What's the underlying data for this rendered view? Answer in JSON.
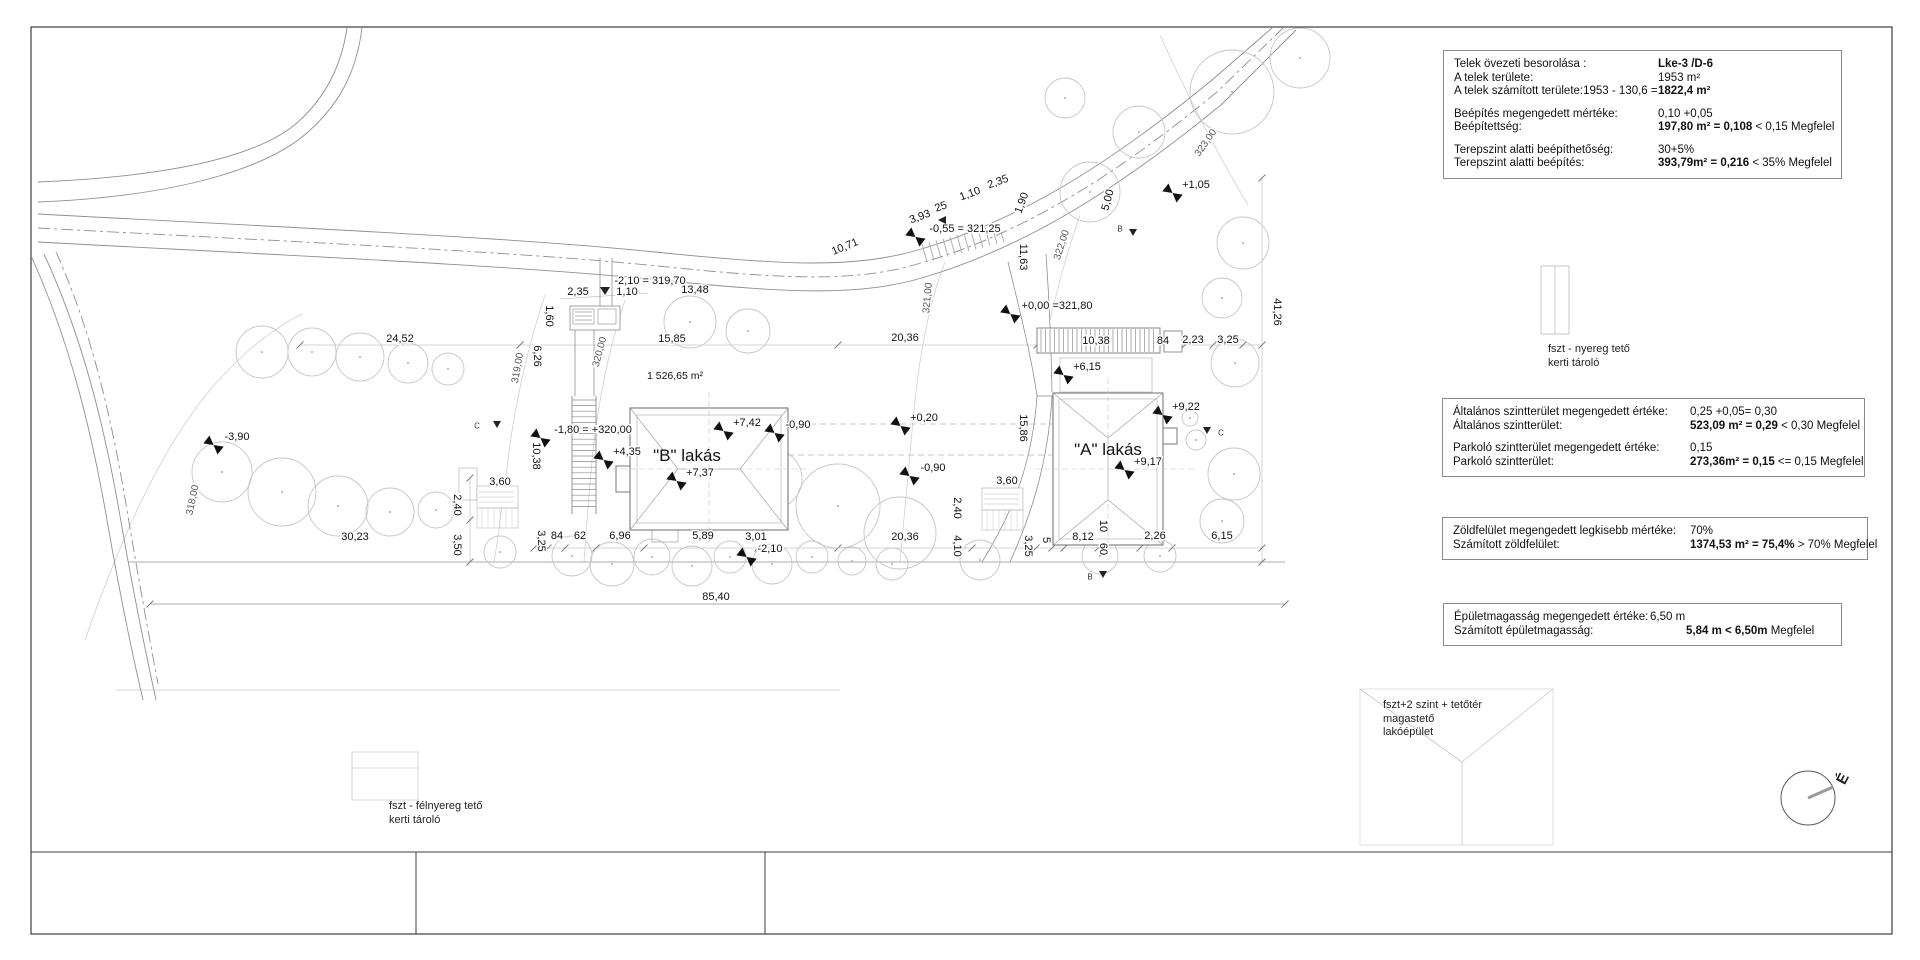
{
  "colors": {
    "frame": "#3c3c3c",
    "line": "#8f8f8f",
    "light": "#c8c8c8",
    "tree": "#c6c6c6",
    "text": "#111111"
  },
  "north": {
    "label": "É",
    "x": 1843,
    "y": 779
  },
  "info_boxes": [
    {
      "id": "zoning",
      "x": 1443,
      "y": 50,
      "w": 377,
      "label_w": 204,
      "rows": [
        {
          "l": "Telek övezeti besorolása :",
          "v": [
            {
              "t": "Lke-3 /D-6",
              "b": 1
            }
          ]
        },
        {
          "l": "A telek területe:",
          "v": [
            {
              "t": "1953 m²",
              "b": 0
            }
          ]
        },
        {
          "l": "A telek számított területe:1953 - 130,6 =",
          "v": [
            {
              "t": "1822,4 m²",
              "b": 1
            }
          ]
        },
        {
          "gap": 1
        },
        {
          "l": "Beépítés megengedett mértéke:",
          "v": [
            {
              "t": "0,10 +0,05",
              "b": 0
            }
          ]
        },
        {
          "l": "Beépítettség:",
          "v": [
            {
              "t": "197,80 m² = 0,108",
              "b": 1
            },
            {
              "t": " < 0,15 Megfelel",
              "b": 0
            }
          ]
        },
        {
          "gap": 1
        },
        {
          "l": "Terepszint alatti beépíthetőség:",
          "v": [
            {
              "t": "30+5%",
              "b": 0
            }
          ]
        },
        {
          "l": "Terepszint alatti beépítés:",
          "v": [
            {
              "t": "393,79m² = 0,216",
              "b": 1
            },
            {
              "t": " < 35%  Megfelel",
              "b": 0
            }
          ]
        }
      ]
    },
    {
      "id": "floor",
      "x": 1442,
      "y": 398,
      "w": 401,
      "label_w": 237,
      "rows": [
        {
          "l": "Általános szintterület megengedett értéke:",
          "v": [
            {
              "t": "0,25 +0,05= 0,30",
              "b": 0
            }
          ]
        },
        {
          "l": "Általános szintterület:",
          "v": [
            {
              "t": "523,09 m²  = 0,29",
              "b": 1
            },
            {
              "t": " < 0,30 Megfelel",
              "b": 0
            }
          ]
        },
        {
          "gap": 1
        },
        {
          "l": "Parkoló szintterület megengedett értéke:",
          "v": [
            {
              "t": "0,15",
              "b": 0
            }
          ]
        },
        {
          "l": "Parkoló szintterület:",
          "v": [
            {
              "t": "273,36m²  = 0,15",
              "b": 1
            },
            {
              "t": " <= 0,15  Megfelel",
              "b": 0
            }
          ]
        }
      ]
    },
    {
      "id": "green",
      "x": 1442,
      "y": 517,
      "w": 404,
      "label_w": 237,
      "rows": [
        {
          "l": "Zöldfelület megengedett legkisebb mértéke:",
          "v": [
            {
              "t": "70%",
              "b": 0
            }
          ]
        },
        {
          "l": "Számított zöldfelület:",
          "v": [
            {
              "t": "1374,53 m² = 75,4%",
              "b": 1
            },
            {
              "t": " > 70% Megfelel",
              "b": 0
            }
          ]
        }
      ]
    },
    {
      "id": "height",
      "x": 1443,
      "y": 603,
      "w": 377,
      "label_w": 196,
      "rows": [
        {
          "l": "Épületmagasság megengedett értéke:",
          "v": [
            {
              "t": "6,50 m",
              "b": 0
            }
          ]
        },
        {
          "l": "Számított épületmagasság:",
          "ind": 36,
          "v": [
            {
              "t": "5,84 m <  6,50m",
              "b": 1
            },
            {
              "t": "  Megfelel",
              "b": 0
            }
          ]
        }
      ]
    }
  ],
  "sketch_labels": [
    {
      "id": "shed1",
      "x": 1548,
      "y": 343,
      "lines": [
        "fszt - nyereg tető",
        "kerti tároló"
      ]
    },
    {
      "id": "main",
      "x": 1383,
      "y": 699,
      "lines": [
        "fszt+2 szint + tetőtér",
        "magastető",
        "lakóépület"
      ]
    },
    {
      "id": "shed2",
      "x": 389,
      "y": 800,
      "lines": [
        "fszt - félnyereg tető",
        "kerti tároló"
      ]
    }
  ],
  "houses": [
    {
      "label": "\"B\" lakás",
      "x": 687,
      "y": 456
    },
    {
      "label": "\"A\" lakás",
      "x": 1108,
      "y": 450
    }
  ],
  "area_label": {
    "t": "1 526,65 m²",
    "x": 675,
    "y": 376
  },
  "levels": [
    {
      "t": "+7,42",
      "x": 747,
      "y": 423
    },
    {
      "t": "-0,90",
      "x": 798,
      "y": 425
    },
    {
      "t": "+0,20",
      "x": 924,
      "y": 418
    },
    {
      "t": "-0,90",
      "x": 933,
      "y": 468
    },
    {
      "t": "+4,35",
      "x": 627,
      "y": 452
    },
    {
      "t": "+7,37",
      "x": 700,
      "y": 473
    },
    {
      "t": "-1,80 = +320,00",
      "x": 593,
      "y": 430
    },
    {
      "t": "+0,00 =321,80",
      "x": 1057,
      "y": 306
    },
    {
      "t": "+6,15",
      "x": 1087,
      "y": 367
    },
    {
      "t": "+9,22",
      "x": 1186,
      "y": 407
    },
    {
      "t": "+9,17",
      "x": 1148,
      "y": 462
    },
    {
      "t": "+1,05",
      "x": 1196,
      "y": 185
    },
    {
      "t": "-3,90",
      "x": 237,
      "y": 437
    },
    {
      "t": "-2,10",
      "x": 770,
      "y": 549
    },
    {
      "t": "-0,55 = 321,25",
      "x": 965,
      "y": 229
    }
  ],
  "dims": [
    {
      "t": "-2,10 = 319,70",
      "x": 650,
      "y": 281
    },
    {
      "t": "13,48",
      "x": 695,
      "y": 290
    },
    {
      "t": "2,35",
      "x": 578,
      "y": 292
    },
    {
      "t": "1,10",
      "x": 627,
      "y": 292
    },
    {
      "t": "24,52",
      "x": 400,
      "y": 339
    },
    {
      "t": "15,85",
      "x": 672,
      "y": 339
    },
    {
      "t": "20,36",
      "x": 905,
      "y": 338
    },
    {
      "t": "10,38",
      "x": 1096,
      "y": 341
    },
    {
      "t": "84",
      "x": 1163,
      "y": 341
    },
    {
      "t": "2,23",
      "x": 1193,
      "y": 340
    },
    {
      "t": "3,25",
      "x": 1228,
      "y": 340
    },
    {
      "t": "41,26",
      "x": 1277,
      "y": 312,
      "r": 90
    },
    {
      "t": "1,60",
      "x": 549,
      "y": 316,
      "r": 90
    },
    {
      "t": "6,26",
      "x": 537,
      "y": 356,
      "r": 90
    },
    {
      "t": "10,38",
      "x": 536,
      "y": 456,
      "r": 90
    },
    {
      "t": "15,86",
      "x": 1023,
      "y": 428,
      "r": 90
    },
    {
      "t": "11,63",
      "x": 1023,
      "y": 257,
      "r": 90
    },
    {
      "t": "5,00",
      "x": 1108,
      "y": 200,
      "r": -75
    },
    {
      "t": "10,71",
      "x": 845,
      "y": 247,
      "r": -22
    },
    {
      "t": "3,93",
      "x": 920,
      "y": 217,
      "r": -20
    },
    {
      "t": "25",
      "x": 941,
      "y": 207,
      "r": -20
    },
    {
      "t": "1,10",
      "x": 970,
      "y": 194,
      "r": -20
    },
    {
      "t": "2,35",
      "x": 998,
      "y": 182,
      "r": -20
    },
    {
      "t": "1,90",
      "x": 1022,
      "y": 203,
      "r": -70
    },
    {
      "t": "3,60",
      "x": 500,
      "y": 482
    },
    {
      "t": "2,40",
      "x": 457,
      "y": 505,
      "r": 90
    },
    {
      "t": "3,50",
      "x": 457,
      "y": 545,
      "r": 90
    },
    {
      "t": "3,60",
      "x": 1007,
      "y": 481
    },
    {
      "t": "2,40",
      "x": 957,
      "y": 508,
      "r": 90
    },
    {
      "t": "30,23",
      "x": 355,
      "y": 537
    },
    {
      "t": "85,40",
      "x": 716,
      "y": 597
    },
    {
      "t": "3,25",
      "x": 541,
      "y": 541,
      "r": 90
    },
    {
      "t": "84",
      "x": 557,
      "y": 536
    },
    {
      "t": "62",
      "x": 580,
      "y": 536
    },
    {
      "t": "6,96",
      "x": 620,
      "y": 536
    },
    {
      "t": "5,89",
      "x": 703,
      "y": 536
    },
    {
      "t": "3,01",
      "x": 756,
      "y": 537
    },
    {
      "t": "20,36",
      "x": 905,
      "y": 537
    },
    {
      "t": "4,10",
      "x": 957,
      "y": 546,
      "r": 90
    },
    {
      "t": "3,25",
      "x": 1028,
      "y": 546,
      "r": 90
    },
    {
      "t": "5",
      "x": 1046,
      "y": 540,
      "r": 90
    },
    {
      "t": "8,12",
      "x": 1083,
      "y": 537
    },
    {
      "t": "10",
      "x": 1103,
      "y": 526,
      "r": 90
    },
    {
      "t": "60",
      "x": 1103,
      "y": 549,
      "r": 90
    },
    {
      "t": "2,26",
      "x": 1155,
      "y": 536
    },
    {
      "t": "6,15",
      "x": 1222,
      "y": 536
    }
  ],
  "contour_labels": [
    {
      "t": "318,00",
      "x": 193,
      "y": 500,
      "r": -78
    },
    {
      "t": "319,00",
      "x": 518,
      "y": 368,
      "r": -80
    },
    {
      "t": "320,00",
      "x": 600,
      "y": 352,
      "r": -75
    },
    {
      "t": "321,00",
      "x": 928,
      "y": 298,
      "r": -85
    },
    {
      "t": "322,00",
      "x": 1062,
      "y": 245,
      "r": -72
    },
    {
      "t": "323,00",
      "x": 1206,
      "y": 143,
      "r": -55
    }
  ],
  "section_markers": [
    {
      "t": "C",
      "x": 477,
      "y": 426,
      "tx": 497,
      "ty": 424
    },
    {
      "t": "C",
      "x": 1221,
      "y": 433,
      "tx": 1207,
      "ty": 430
    },
    {
      "t": "B",
      "x": 1120,
      "y": 229,
      "tx": 1133,
      "ty": 232
    },
    {
      "t": "B",
      "x": 1090,
      "y": 577,
      "tx": 1103,
      "ty": 574
    }
  ]
}
